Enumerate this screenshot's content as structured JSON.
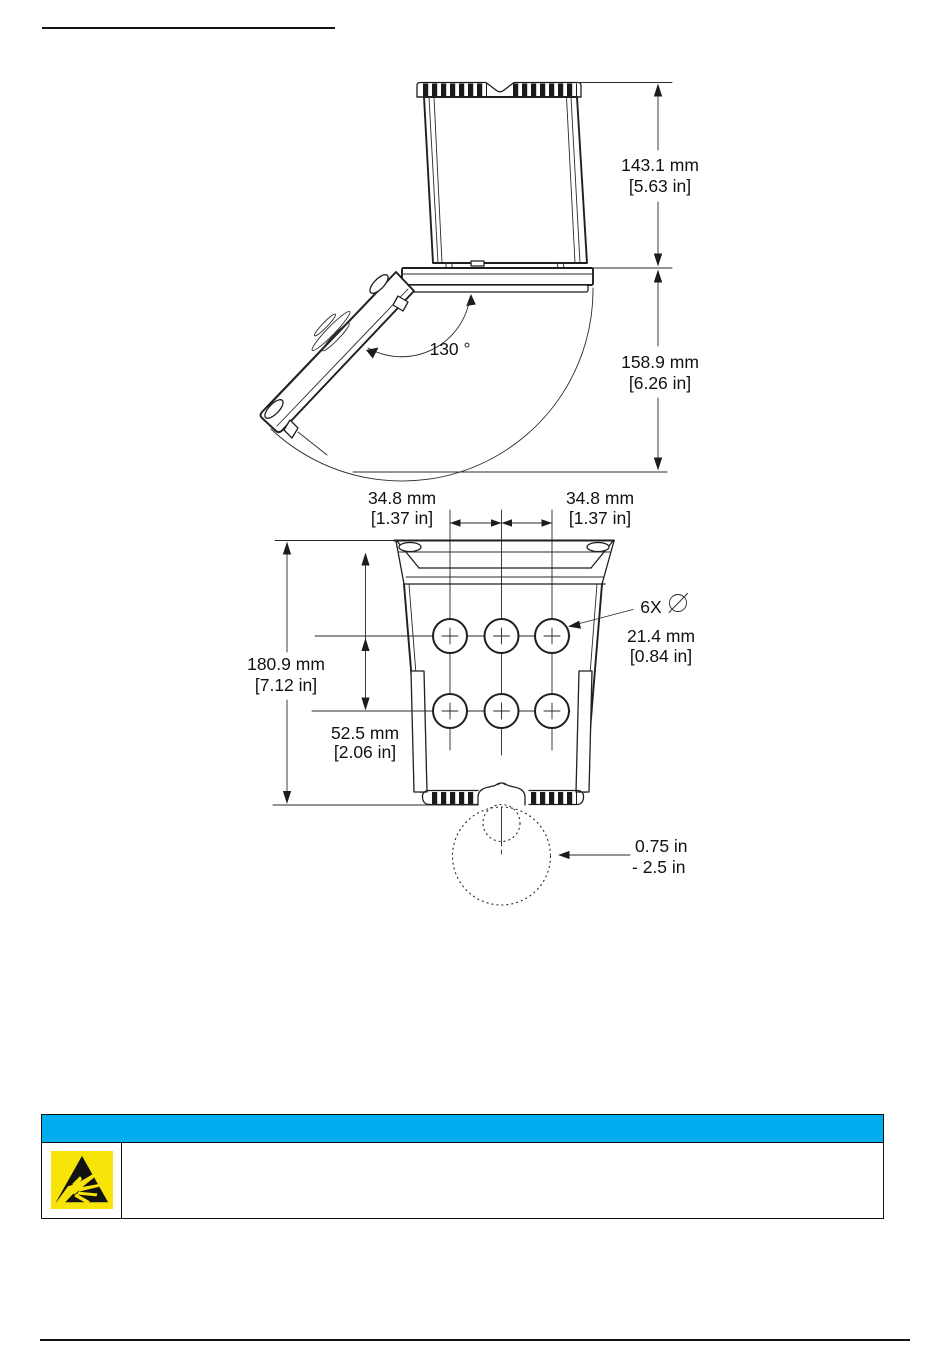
{
  "page": {
    "background_color": "#ffffff"
  },
  "figure": {
    "side_view": {
      "upper_height_mm": "143.1 mm",
      "upper_height_in": "[5.63 in]",
      "lower_height_mm": "158.9 mm",
      "lower_height_in": "[6.26 in]",
      "door_open_angle": "130 °"
    },
    "bottom_view": {
      "left_hole_spacing_mm": "34.8 mm",
      "left_hole_spacing_in": "[1.37 in]",
      "right_hole_spacing_mm": "34.8 mm",
      "right_hole_spacing_in": "[1.37 in]",
      "enclosure_height_mm": "180.9 mm",
      "enclosure_height_in": "[7.12 in]",
      "hole_row_spacing_mm": "52.5 mm",
      "hole_row_spacing_in": "[2.06 in]",
      "hole_count_callout": "6X",
      "hole_diameter_mm": "21.4 mm",
      "hole_diameter_in": "[0.84 in]",
      "conduit_range_line1": "0.75 in",
      "conduit_range_line2": "- 2.5 in"
    }
  },
  "notice": {
    "header_bar_color": "#00AEEF",
    "icon_name": "esd-warning-icon",
    "icon_background_color": "#F6E409"
  }
}
